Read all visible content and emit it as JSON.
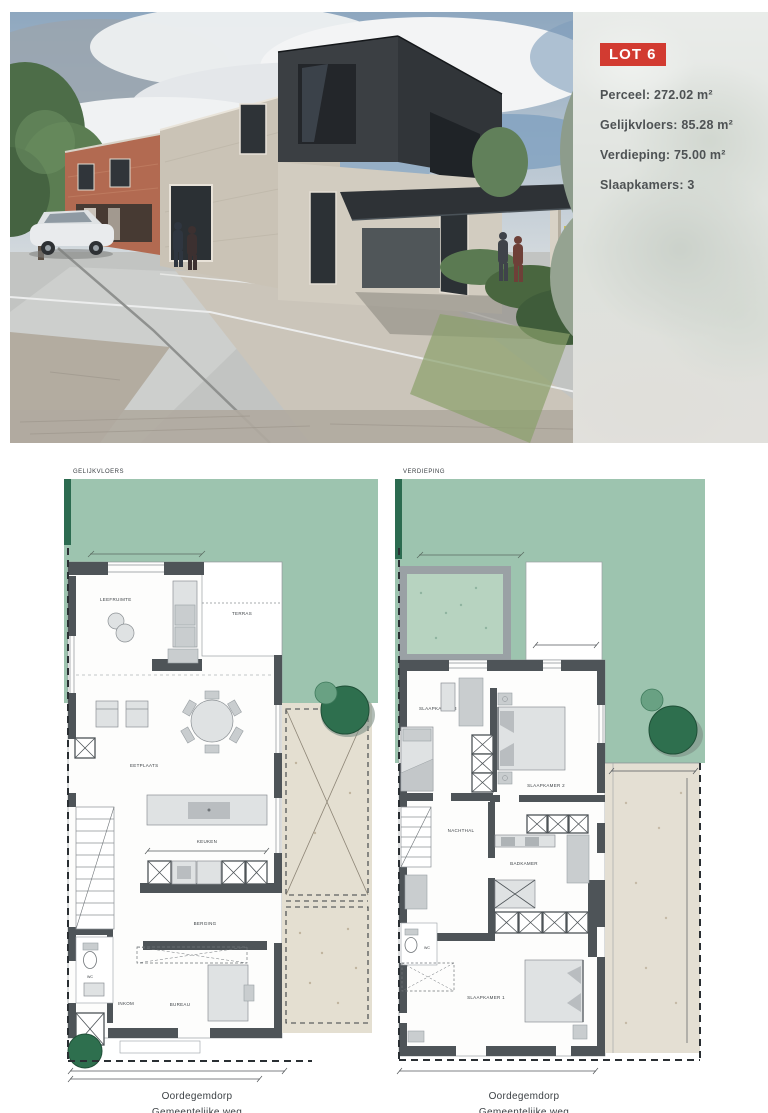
{
  "photo": {
    "badge": "LOT 6",
    "specs": [
      {
        "label": "Perceel:",
        "value": "272.02 m²"
      },
      {
        "label": "Gelijkvloers:",
        "value": "85.28 m²"
      },
      {
        "label": "Verdieping:",
        "value": "75.00 m²"
      },
      {
        "label": "Slaapkamers:",
        "value": "3"
      }
    ]
  },
  "ground_plan": {
    "title": "GELIJKVLOERS",
    "rooms": {
      "leefruimte": "LEEFRUIMTE",
      "terras": "TERRAS",
      "eetplaats": "EETPLAATS",
      "keuken": "KEUKEN",
      "berging": "BERGING",
      "wc": "WC",
      "inkom": "INKOM",
      "bureau": "BUREAU"
    },
    "street": "Oordegemdorp",
    "road": "Gemeentelijke weg"
  },
  "upper_plan": {
    "title": "VERDIEPING",
    "rooms": {
      "slaapkamer3": "SLAAPKAMER 3",
      "slaapkamer2": "SLAAPKAMER 2",
      "nachthal": "NACHTHAL",
      "badkamer": "BADKAMER",
      "wc": "WC",
      "slaapkamer1": "SLAAPKAMER 1"
    },
    "street": "Oordegemdorp",
    "road": "Gemeentelijke weg"
  },
  "colors": {
    "badge": "#d23b31",
    "garden_green": "#9dc4af",
    "hedge_green": "#2c6b50",
    "wall_gray": "#4e5458",
    "paving_beige": "#e4dfd1",
    "tree_green": "#2e6f4e"
  }
}
